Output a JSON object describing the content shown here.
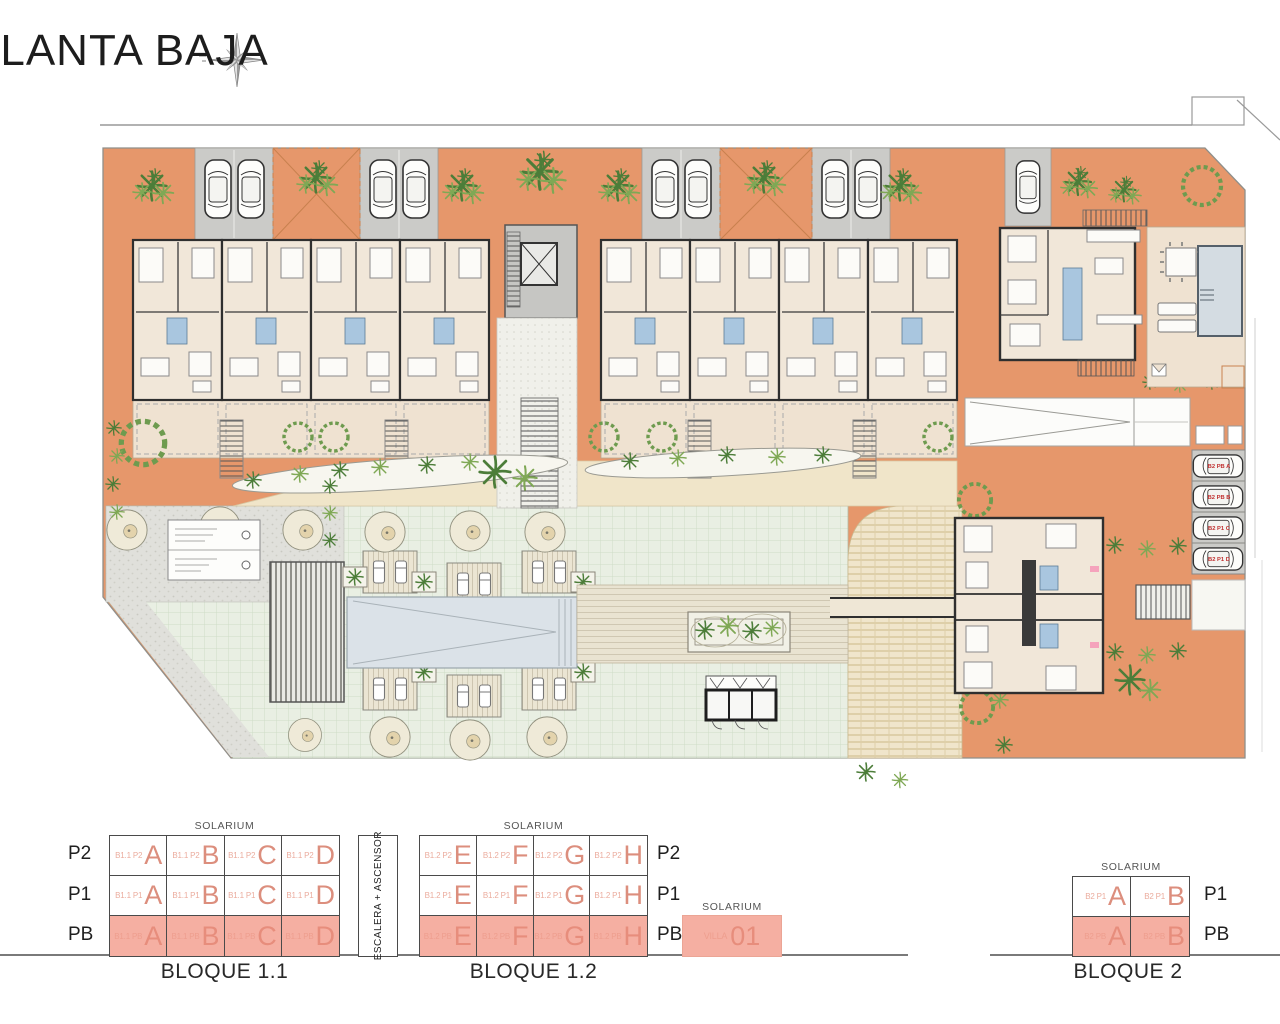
{
  "title": "PLANTA BAJA",
  "site": {
    "parking_labels": [
      "B2 PB A",
      "B2 PB B",
      "B2 P1 C",
      "B2 P1 D"
    ]
  },
  "legend": {
    "solarium": "SOLARIUM",
    "escalera": "ESCALERA + ASCENSOR",
    "b11": {
      "name": "BLOQUE 1.1",
      "row_labels": [
        "P2",
        "P1",
        "PB"
      ],
      "p2": [
        {
          "code": "B1.1 P2",
          "letter": "A"
        },
        {
          "code": "B1.1 P2",
          "letter": "B"
        },
        {
          "code": "B1.1 P2",
          "letter": "C"
        },
        {
          "code": "B1.1 P2",
          "letter": "D"
        }
      ],
      "p1": [
        {
          "code": "B1.1 P1",
          "letter": "A"
        },
        {
          "code": "B1.1 P1",
          "letter": "B"
        },
        {
          "code": "B1.1 P1",
          "letter": "C"
        },
        {
          "code": "B1.1 P1",
          "letter": "D"
        }
      ],
      "pb": [
        {
          "code": "B1.1 PB",
          "letter": "A"
        },
        {
          "code": "B1.1 PB",
          "letter": "B"
        },
        {
          "code": "B1.1 PB",
          "letter": "C"
        },
        {
          "code": "B1.1 PB",
          "letter": "D"
        }
      ]
    },
    "b12": {
      "name": "BLOQUE 1.2",
      "row_labels": [
        "P2",
        "P1",
        "PB"
      ],
      "p2": [
        {
          "code": "B1.2 P2",
          "letter": "E"
        },
        {
          "code": "B1.2 P2",
          "letter": "F"
        },
        {
          "code": "B1.2 P2",
          "letter": "G"
        },
        {
          "code": "B1.2 P2",
          "letter": "H"
        }
      ],
      "p1": [
        {
          "code": "B1.2 P1",
          "letter": "E"
        },
        {
          "code": "B1.2 P1",
          "letter": "F"
        },
        {
          "code": "B1.2 P1",
          "letter": "G"
        },
        {
          "code": "B1.2 P1",
          "letter": "H"
        }
      ],
      "pb": [
        {
          "code": "B1.2 PB",
          "letter": "E"
        },
        {
          "code": "B1.2 PB",
          "letter": "F"
        },
        {
          "code": "B1.2 PB",
          "letter": "G"
        },
        {
          "code": "B1.2 PB",
          "letter": "H"
        }
      ]
    },
    "villa": {
      "code": "VILLA",
      "number": "01"
    },
    "b2": {
      "name": "BLOQUE 2",
      "row_labels": [
        "P1",
        "PB"
      ],
      "p1": [
        {
          "code": "B2 P1",
          "letter": "A"
        },
        {
          "code": "B2 P1",
          "letter": "B"
        }
      ],
      "pb": [
        {
          "code": "B2 PB",
          "letter": "A"
        },
        {
          "code": "B2 PB",
          "letter": "B"
        }
      ]
    }
  }
}
